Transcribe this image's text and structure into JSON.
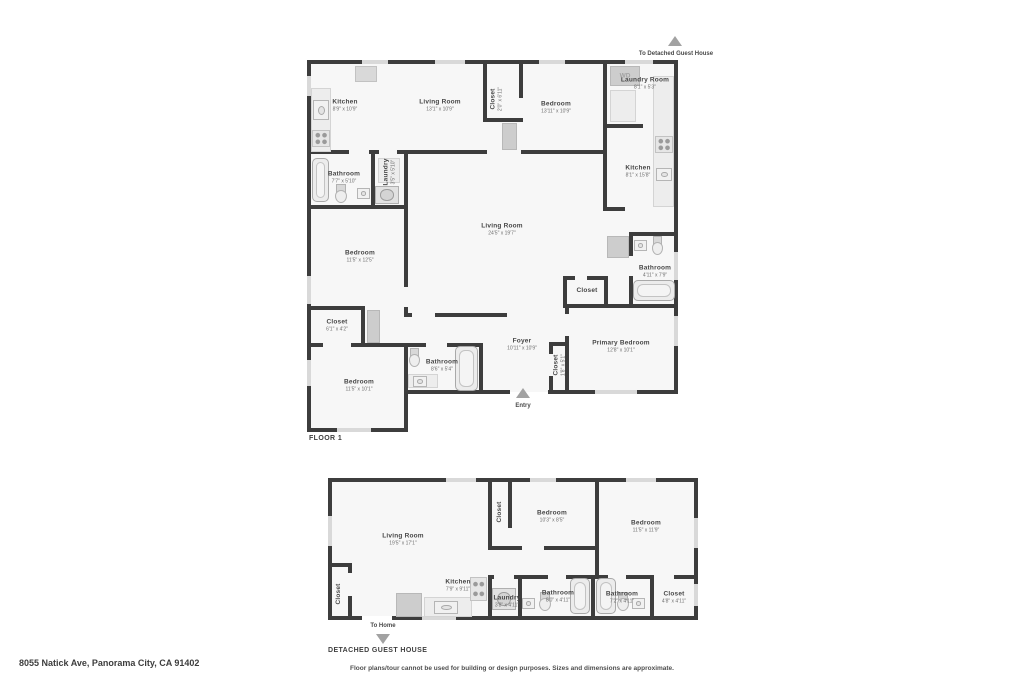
{
  "address": "8055 Natick Ave, Panorama City, CA 91402",
  "disclaimer": "Floor plans/tour cannot be used for building or design purposes. Sizes and dimensions are approximate.",
  "floor1": {
    "label": "FLOOR 1",
    "to_guest_house": "To Detached Guest House",
    "entry_label": "Entry",
    "wd_label": "WD",
    "rooms": {
      "kitchen_tl": {
        "name": "Kitchen",
        "dims": "8'9\" x 10'9\""
      },
      "living_top": {
        "name": "Living Room",
        "dims": "13'1\" x 10'9\""
      },
      "closet_top": {
        "name": "Closet",
        "dims": "2'0\" x 6'11\""
      },
      "bedroom_top": {
        "name": "Bedroom",
        "dims": "13'11\" x 10'9\""
      },
      "laundry_room": {
        "name": "Laundry Room",
        "dims": "8'1\" x 5'3\""
      },
      "kitchen_right": {
        "name": "Kitchen",
        "dims": "8'1\" x 15'8\""
      },
      "bathroom_left": {
        "name": "Bathroom",
        "dims": "7'7\" x 5'10\""
      },
      "laundry_left": {
        "name": "Laundry",
        "dims": "3'5\" x 5'10\""
      },
      "living_main": {
        "name": "Living Room",
        "dims": "24'5\" x 19'7\""
      },
      "bedroom_mid": {
        "name": "Bedroom",
        "dims": "11'5\" x 12'5\""
      },
      "bathroom_right": {
        "name": "Bathroom",
        "dims": "4'11\" x 7'9\""
      },
      "closet_center": {
        "name": "Closet",
        "dims": ""
      },
      "closet_left": {
        "name": "Closet",
        "dims": "6'1\" x 4'2\""
      },
      "foyer": {
        "name": "Foyer",
        "dims": "10'11\" x 10'9\""
      },
      "bathroom_bottom": {
        "name": "Bathroom",
        "dims": "8'6\" x 5'4\""
      },
      "bedroom_bottom": {
        "name": "Bedroom",
        "dims": "11'5\" x 10'1\""
      },
      "closet_foyer": {
        "name": "Closet",
        "dims": "1'8\" x 5'1\""
      },
      "primary_bedroom": {
        "name": "Primary Bedroom",
        "dims": "12'8\" x 10'1\""
      }
    }
  },
  "guest_house": {
    "label": "DETACHED GUEST HOUSE",
    "to_home": "To Home",
    "rooms": {
      "living": {
        "name": "Living Room",
        "dims": "19'5\" x 17'1\""
      },
      "closet_mid": {
        "name": "Closet",
        "dims": ""
      },
      "bedroom_1": {
        "name": "Bedroom",
        "dims": "10'3\" x 8'5\""
      },
      "bedroom_2": {
        "name": "Bedroom",
        "dims": "11'5\" x 11'9\""
      },
      "kitchen": {
        "name": "Kitchen",
        "dims": "7'9\" x 9'11\""
      },
      "closet_left": {
        "name": "Closet",
        "dims": ""
      },
      "laundry": {
        "name": "Laundry",
        "dims": "3'8\" x 4'11\""
      },
      "bathroom_1": {
        "name": "Bathroom",
        "dims": "8'0\" x 4'11\""
      },
      "bathroom_2": {
        "name": "Bathroom",
        "dims": "7'2\" x 4'11\""
      },
      "closet_right": {
        "name": "Closet",
        "dims": "4'8\" x 4'11\""
      }
    }
  }
}
